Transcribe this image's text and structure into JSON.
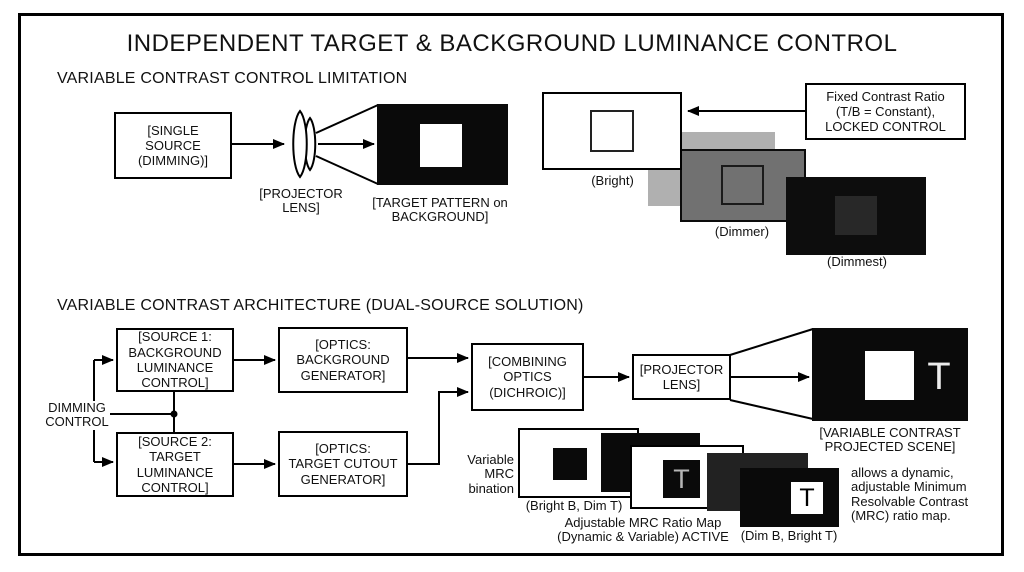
{
  "title": "INDEPENDENT TARGET & BACKGROUND LUMINANCE CONTROL",
  "section1": {
    "heading": "VARIABLE CONTRAST CONTROL LIMITATION",
    "source_box": "[SINGLE\nSOURCE\n(DIMMING)]",
    "lens_label": "[PROJECTOR\nLENS]",
    "target_label": "[TARGET PATTERN on\nBACKGROUND]",
    "fixed_ratio_box": "Fixed Contrast Ratio\n(T/B = Constant),\nLOCKED CONTROL",
    "bright_label": "(Bright)",
    "dimmer_label": "(Dimmer)",
    "dimmest_label": "(Dimmest)"
  },
  "section2": {
    "heading": "VARIABLE CONTRAST ARCHITECTURE (DUAL-SOURCE SOLUTION)",
    "dimming_control": "DIMMING\nCONTROL",
    "source1_box": "[SOURCE 1:\nBACKGROUND\nLUMINANCE\nCONTROL]",
    "source2_box": "[SOURCE 2:\nTARGET\nLUMINANCE\nCONTROL]",
    "optics_background_box": "[OPTICS:\nBACKGROUND\nGENERATOR]",
    "optics_target_box": "[OPTICS:\nTARGET CUTOUT\nGENERATOR]",
    "combining_optics_box": "[COMBINING\nOPTICS\n(DICHROIC)]",
    "projector_lens_box": "[PROJECTOR\nLENS]",
    "scene_label": "[VARIABLE CONTRAST\nPROJECTED SCENE]",
    "scene_t": "T",
    "mrc": {
      "variable_label": "Variable\nMRC\nbination",
      "bright_label": "(Bright B, Dim T)",
      "map_label": "Adjustable MRC Ratio Map\n(Dynamic & Variable) ACTIVE",
      "dim_label": "(Dim B, Bright T)",
      "t_gray": "T",
      "t_black": "T"
    },
    "note": "allows a dynamic,\nadjustable Minimum\nResolvable Contrast\n(MRC) ratio map."
  },
  "colors": {
    "light_gray": "#b0b0b0",
    "mid_gray": "#717171",
    "near_black": "#0d0d0d",
    "dim_square": "#282828",
    "dark_panel": "#222222",
    "black_panel": "#0a0a0a"
  }
}
